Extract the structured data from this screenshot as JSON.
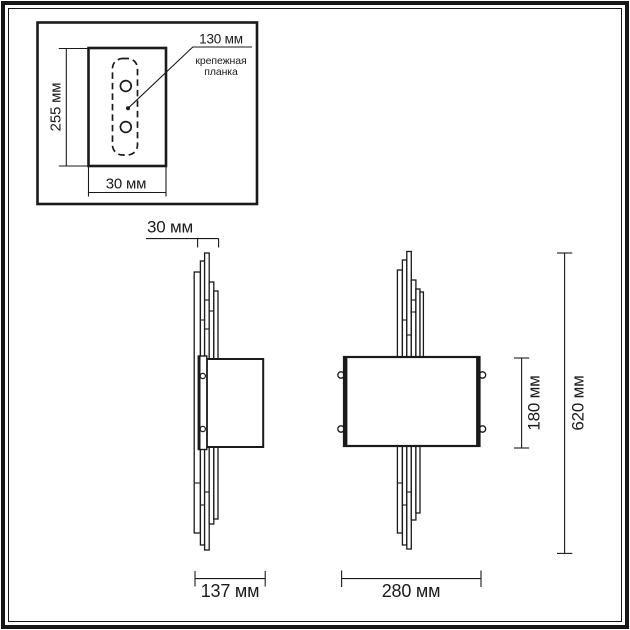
{
  "inset": {
    "height_dim": "255 мм",
    "width_dim": "30 мм",
    "bracket_dim": "130 мм",
    "bracket_label_line1": "крепежная",
    "bracket_label_line2": "планка"
  },
  "side_view": {
    "rod_width_dim": "30 мм",
    "depth_dim": "137 мм"
  },
  "front_view": {
    "width_dim": "280 мм",
    "shade_height_dim": "180 мм",
    "total_height_dim": "620 мм"
  },
  "colors": {
    "line": "#1a1a1a",
    "background": "#ffffff"
  }
}
